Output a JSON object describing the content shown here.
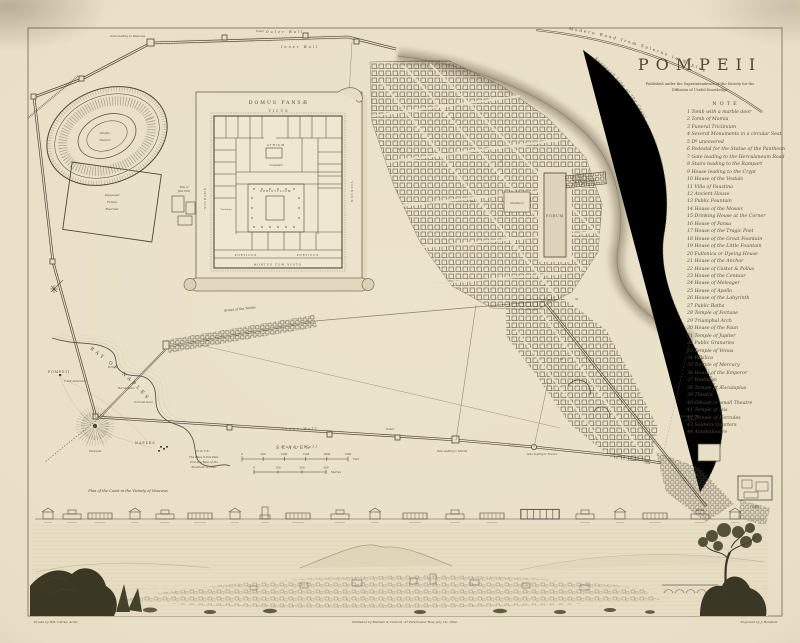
{
  "plate": {
    "paper": "#eae0c6",
    "ink": "#4f4937",
    "faint": "#8a8068",
    "shade": "#b9af9a"
  },
  "title": {
    "text": "POMPEII",
    "sub1": "Published under the Superintendence of the Society for the",
    "sub2": "Diffusion of Useful Knowledge."
  },
  "note": {
    "heading": "NOTE",
    "items": [
      "1 Tomb with a marble door",
      "2 Tomb of Mamia",
      "3 Funeral Triclinium",
      "4 Several Monuments in a circular Seat",
      "5 Dº uncovered",
      "6 Pedestal for the Statue of the Pantheon",
      "7 Gate leading to the Herculaneum Road",
      "8 Stairs leading to the Rampart",
      "9 House leading to the Crypt",
      "10 House of the Vestals",
      "11 Villa of Faustina",
      "12 Ancient House",
      "13 Public Fountain",
      "14 House of the Mosaic",
      "15 Drinking House at the Corner",
      "16 House of Pansa",
      "17 House of the Tragic Poet",
      "18 House of the Great Fountain",
      "19 House of the Little Fountain",
      "20 Fullonica or Dyeing House",
      "21 House of the Anchor",
      "22 House of Castor & Pollux",
      "23 House of the Centaur",
      "24 House of Meleager",
      "25 House of Apollo",
      "26 House of the Labyrinth",
      "27 Public Baths",
      "28 Temple of Fortune",
      "29 Triumphal Arch",
      "30 House of the Faun",
      "31 Temple of Jupiter",
      "32 Public Granaries",
      "33 Temple of Venus",
      "34 Basilica",
      "35 Temple of Mercury",
      "36 House of the Emperor",
      "37 Pantheon",
      "38 Temple of Æsculapius",
      "39 Theatre",
      "40 Odeum or small Theatre",
      "41 Temple of Isis",
      "42 Temple of Hercules",
      "43 Soldiers Quarters",
      "44 Amphitheatre"
    ]
  },
  "map": {
    "outer_wall": "Outer Wall",
    "inner_wall": "Inner Wall",
    "tower": "Tower",
    "modern_road": "Modern Road from Salerno to Naples",
    "coast_line": "Supposed Line of the Coast",
    "port": "Port of Pompeii",
    "forum": "FORUM",
    "basilica": "BASILICA",
    "pantheon": "Pantheon",
    "amphitheatre": [
      "Amphi-",
      "theatre"
    ],
    "supposed_square": [
      "Supposed",
      "Forum",
      "Boarium"
    ],
    "villa_julia": [
      "Villa of",
      "Julia Felix"
    ],
    "street_of_tombs": "Street of the Tombs",
    "gate_vesuvius": "Gate leading to Vesuvius",
    "gate_stabiae": "Gate leading to Stabiæ",
    "gate_nocera": "Gate leading to Nocera",
    "suburban_villa": [
      "Suburban Villa",
      "of Cicero"
    ],
    "villa": "Villa",
    "ref_numbers": [
      "16",
      "22",
      "27",
      "31",
      "34",
      "40"
    ]
  },
  "domus": {
    "title": "DOMUS PANSÆ",
    "vicus": "VICUS",
    "viculus_left": "VICULUS",
    "viculus_right": "VICULUS",
    "atrium": "ATRIUM",
    "cavaedium": "Cavædium",
    "peristylium": "PERISTYLIUM",
    "triclinium": "Triclinium",
    "porticus_1": "PORTICUS",
    "porticus_2": "PORTICUS",
    "hortus": "HORTUS CUM XYSTO"
  },
  "bay": {
    "title": "BAY OF NAPLES",
    "pompeii": "POMPEII",
    "naples": "NAPLES",
    "vesuvius": "Vesuvius",
    "towns": [
      "Portici",
      "Herculaneum",
      "Torre del Greco",
      "T. dell' Annunziata"
    ],
    "note_heading": "NOTE.",
    "note_lines": [
      "The Plain in this Plan,",
      "from the Base of the",
      "Mountain, is Lava."
    ],
    "caption": "Plan of the Coast in the Vicinity of Vesuvius"
  },
  "scales": {
    "heading": "SCALES",
    "feet_ticks": [
      "0",
      "500",
      "1000",
      "1500",
      "2000",
      "2500"
    ],
    "feet_unit": "Feet",
    "metre_ticks": [
      "0",
      "100",
      "200",
      "300"
    ],
    "metre_unit": "Metres"
  },
  "imprint": {
    "left": "Drawn by W.B. Clarke, Archt.",
    "center": "Published by Baldwin & Cradock, 47 Paternoster Row, July 1st. 1832.",
    "right": "Engraved by J. Henshall."
  }
}
